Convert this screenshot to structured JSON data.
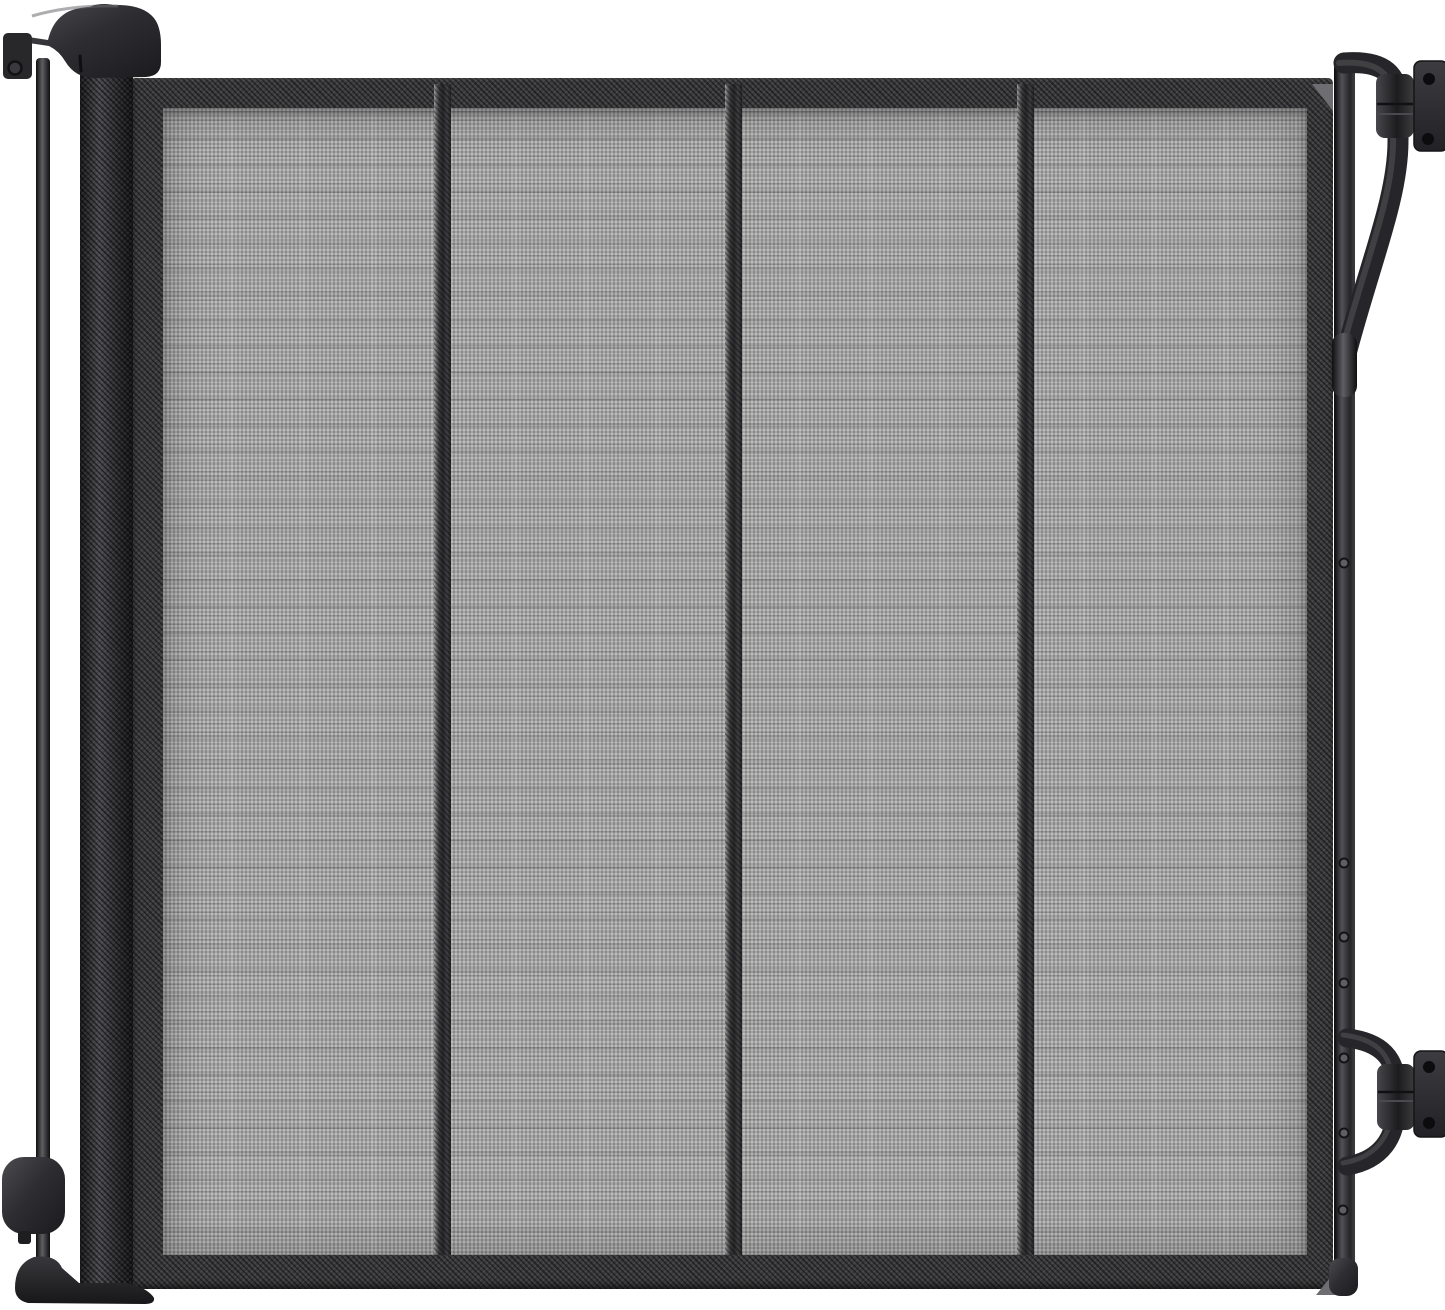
{
  "colors": {
    "background": "#ffffff",
    "mesh-base": "#a8a8a8",
    "frame": "#3a3a3c",
    "hw-dark": "#232327",
    "hw-mid": "#3f3f44",
    "hw-light": "#5a5a60",
    "plate": "#323237",
    "screw-hole": "#0c0c0e"
  },
  "scene": {
    "subject": "retractable-mesh-safety-gate",
    "mesh_sections": 4,
    "mesh_dividers": 3,
    "wall_mount_plates": 2,
    "latch_bar_screws": 7,
    "visible_text": ""
  }
}
